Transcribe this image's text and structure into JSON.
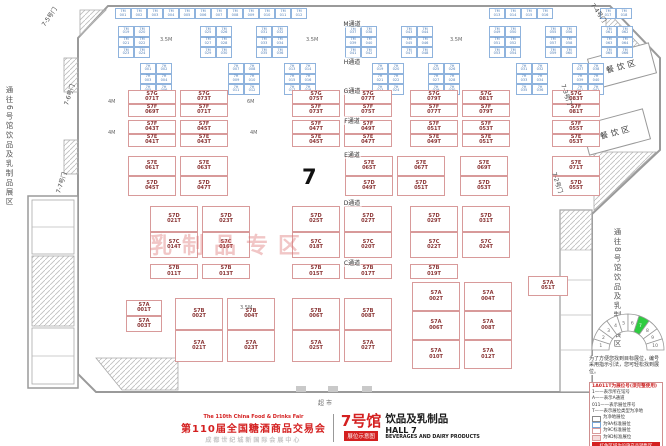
{
  "labels": {
    "hall_number": "7",
    "watermark": "乳制品专区",
    "dining": "餐饮区",
    "supermarket": "超市",
    "side_left": "通往6号馆饮品及乳制品展区",
    "side_right": "通往8号馆饮品及乳制品展区"
  },
  "corridors": [
    {
      "label": "M通道",
      "x": 352,
      "y": 19
    },
    {
      "label": "H通道",
      "x": 352,
      "y": 57
    },
    {
      "label": "G通道",
      "x": 352,
      "y": 86
    },
    {
      "label": "F通道",
      "x": 352,
      "y": 116
    },
    {
      "label": "E通道",
      "x": 352,
      "y": 150
    },
    {
      "label": "D通道",
      "x": 352,
      "y": 198
    },
    {
      "label": "C通道",
      "x": 352,
      "y": 258
    }
  ],
  "gates": [
    {
      "label": "7-5号门",
      "x": 38,
      "y": 12,
      "rot": -55
    },
    {
      "label": "7-4号门",
      "x": 588,
      "y": 8,
      "rot": 55
    },
    {
      "label": "7-6号门",
      "x": 58,
      "y": 90,
      "rot": -72
    },
    {
      "label": "7-7号门",
      "x": 50,
      "y": 178,
      "rot": -72
    },
    {
      "label": "7-3号门",
      "x": 556,
      "y": 90,
      "rot": 72
    },
    {
      "label": "7-2号门",
      "x": 547,
      "y": 178,
      "rot": 72
    }
  ],
  "dim_notes": [
    {
      "t": "3.5M",
      "x": 160,
      "y": 37
    },
    {
      "t": "3.5M",
      "x": 306,
      "y": 37
    },
    {
      "t": "3.5M",
      "x": 450,
      "y": 37
    },
    {
      "t": "4M",
      "x": 108,
      "y": 99
    },
    {
      "t": "6M",
      "x": 247,
      "y": 99
    },
    {
      "t": "4M",
      "x": 108,
      "y": 130
    },
    {
      "t": "4M",
      "x": 250,
      "y": 130
    },
    {
      "t": "3.5M",
      "x": 240,
      "y": 305
    }
  ],
  "booths": {
    "top_strip": [
      "7M001",
      "7M002",
      "7M003",
      "7M004",
      "7M005",
      "7M006",
      "7M007",
      "7M008",
      "7M009",
      "7M010",
      "7M011",
      "7M012",
      "7M013",
      "7M014",
      "7M015",
      "7M016",
      "7M017",
      "7M018"
    ],
    "blue1": [
      "7M019",
      "7M020",
      "7M021",
      "7M022",
      "7M023",
      "7M024",
      "7M025",
      "7M026",
      "7M027",
      "7M028",
      "7M029",
      "7M030",
      "7M031",
      "7M032",
      "7M033",
      "7M034",
      "7M035",
      "7M036",
      "7M037",
      "7M038",
      "7M039",
      "7M040",
      "7M041",
      "7M042",
      "7M043",
      "7M044",
      "7M045",
      "7M046",
      "7M047",
      "7M048",
      "7M049",
      "7M050",
      "7M051",
      "7M052",
      "7M053",
      "7M054",
      "7M055",
      "7M056",
      "7M057",
      "7M058",
      "7M059",
      "7M060",
      "7M061",
      "7M062",
      "7M063",
      "7M064",
      "7M065",
      "7M066"
    ],
    "blue2": [
      "7H001",
      "7H002",
      "7H003",
      "7H004",
      "7H005",
      "7H006",
      "7H007",
      "7H008",
      "7H009",
      "7H010",
      "7H011",
      "7H012",
      "7H013",
      "7H014",
      "7H015",
      "7H016",
      "7H017",
      "7H018",
      "7H019",
      "7H020",
      "7H021",
      "7H022",
      "7H023",
      "7H024",
      "7H025",
      "7H026",
      "7H027",
      "7H028",
      "7H029",
      "7H030",
      "7H031",
      "7H032",
      "7H033",
      "7H034",
      "7H035",
      "7H036",
      "7H037",
      "7H038",
      "7H039",
      "7H040",
      "7H041",
      "7H042"
    ],
    "gf_top": [
      "S7G071T",
      "S7G073T",
      "S7G075T",
      "S7G077T",
      "S7G079T",
      "S7G081T",
      "S7G083T"
    ],
    "gf_bot": [
      "S7F069T",
      "S7F071T",
      "S7F073T",
      "S7F075T",
      "S7F077T",
      "S7F079T",
      "S7F081T"
    ],
    "fe_top": [
      "S7F043T",
      "S7F045T",
      "S7F047T",
      "S7F049T",
      "S7F051T",
      "S7F053T",
      "S7F055T"
    ],
    "fe_bot": [
      "S7E041T",
      "S7E043T",
      "S7E045T",
      "S7E047T",
      "S7E049T",
      "S7E051T",
      "S7E053T"
    ],
    "ed_top": [
      "S7E061T",
      "S7E063T",
      "S7E065T",
      "S7E067T",
      "S7E069T",
      "S7E071T"
    ],
    "ed_bot": [
      "S7D045T",
      "S7D047T",
      "S7D049T",
      "S7D051T",
      "S7D053T",
      "S7D055T"
    ],
    "dc_top": [
      "S7D021T",
      "S7D023T",
      "S7D025T",
      "S7D027T",
      "S7D029T",
      "S7D031T"
    ],
    "dc_bot": [
      "S7C014T",
      "S7C016T",
      "S7C018T",
      "S7C020T",
      "S7C022T",
      "S7C024T"
    ],
    "cb": [
      "S7B011T",
      "S7B013T",
      "S7B015T",
      "S7B017T",
      "S7B019T"
    ],
    "ba_top": [
      "S7B002T",
      "S7B004T",
      "S7B006T",
      "S7B008T"
    ],
    "ba_bot": [
      "S7A021T",
      "S7A023T",
      "S7A025T",
      "S7A027T"
    ],
    "rg1": [
      "S7A002T",
      "S7A004T"
    ],
    "rg2": [
      "S7A006T",
      "S7A008T"
    ],
    "rg3": [
      "S7A010T",
      "S7A012T"
    ],
    "lp1": [
      "S7A001T"
    ],
    "lp2": [
      "S7A003T"
    ],
    "single": [
      "S7A051T"
    ]
  },
  "legend": {
    "note": "为了方便您找到目标展位，编号采用指示引法，您可轻松找到展位。",
    "title": "1A011T为展位号(须完整使用)",
    "items": [
      "1——表示所在馆号",
      "A——表示A通道",
      "011——表示展位序号",
      "T——表示展位类型为净地"
    ],
    "swatches": [
      "为净地展位",
      "为9A标准展位",
      "为9C标准展位",
      "为9D标准展位"
    ],
    "footer": "红色区域为设施产品销售区",
    "halls": [
      "1",
      "2",
      "3",
      "4",
      "5",
      "6",
      "7",
      "8",
      "9",
      "10"
    ],
    "highlight": "7"
  },
  "footer": {
    "en_title": "The 110th China Food & Drinks Fair",
    "cn_title": "第110届全国糖酒商品交易会",
    "venue": "成都世纪城新国际会展中心",
    "hall_cn": "7号馆",
    "badge": "展位示意图",
    "hall_topic": "饮品及乳制品",
    "hall_en": "HALL 7",
    "topic_en": "BEVERAGES AND DAIRY PRODUCTS"
  }
}
